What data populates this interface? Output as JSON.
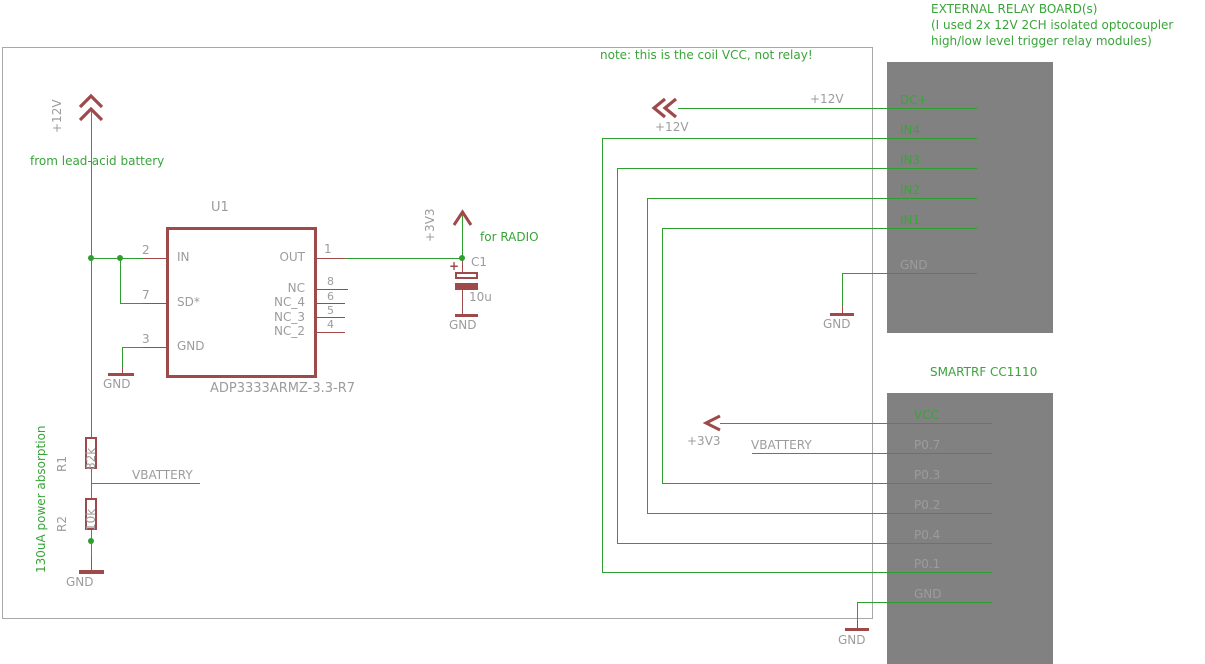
{
  "annotations": {
    "relay_title_1": "EXTERNAL RELAY BOARD(s)",
    "relay_title_2": "(I used 2x 12V 2CH isolated optocoupler",
    "relay_title_3": "high/low level trigger relay modules)",
    "coil_note": "note: this is the coil VCC, not relay!",
    "battery_source": "from lead-acid battery",
    "radio_note": "for RADIO",
    "power_absorption": "130uA power absorption"
  },
  "power": {
    "v12": "+12V",
    "v3v3": "+3V3",
    "gnd": "GND",
    "vbattery": "VBATTERY"
  },
  "u1": {
    "ref": "U1",
    "part": "ADP3333ARMZ-3.3-R7",
    "pins_left": [
      {
        "num": "2",
        "name": "IN"
      },
      {
        "num": "7",
        "name": "SD*"
      },
      {
        "num": "3",
        "name": "GND"
      }
    ],
    "pins_right": [
      {
        "num": "1",
        "name": "OUT"
      },
      {
        "num": "8",
        "name": "NC"
      },
      {
        "num": "6",
        "name": "NC_4"
      },
      {
        "num": "5",
        "name": "NC_3"
      },
      {
        "num": "4",
        "name": "NC_2"
      }
    ]
  },
  "c1": {
    "ref": "C1",
    "value": "10u",
    "polarity": "+"
  },
  "r1": {
    "ref": "R1",
    "value": "82k"
  },
  "r2": {
    "ref": "R2",
    "value": "10k"
  },
  "relay_board": {
    "pins": [
      "DC+",
      "IN4",
      "IN3",
      "IN2",
      "IN1",
      "GND"
    ]
  },
  "cc1110": {
    "title": "SMARTRF CC1110",
    "pins": [
      "VCC",
      "P0.7",
      "P0.3",
      "P0.2",
      "P0.4",
      "P0.1",
      "GND"
    ]
  },
  "colors": {
    "wire_green": "#2f9e2f",
    "symbol_red": "#9e4a4a",
    "label_gray": "#9c9c9c",
    "text_green": "#3aa43a",
    "module_gray": "#818181"
  }
}
